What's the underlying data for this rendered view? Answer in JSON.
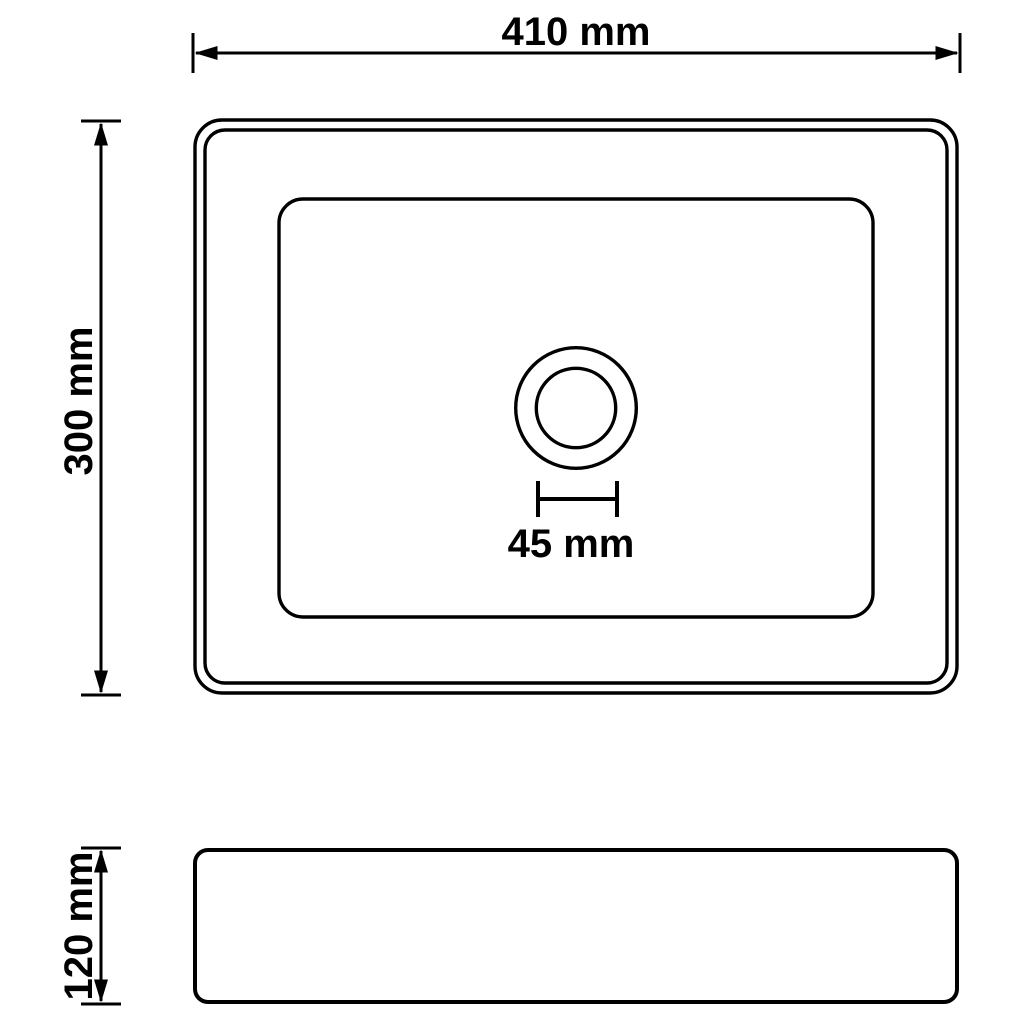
{
  "diagram": {
    "type": "technical-dimension-drawing",
    "subject": "rectangular basin with center drain, plan view and side view",
    "background_color": "#ffffff",
    "line_color": "#000000",
    "views": {
      "top_view": {
        "name": "plan-view",
        "width_label": "410 mm",
        "depth_label": "300 mm",
        "drain_diameter_label": "45 mm"
      },
      "side_view": {
        "name": "side-view",
        "height_label": "120 mm"
      }
    }
  }
}
